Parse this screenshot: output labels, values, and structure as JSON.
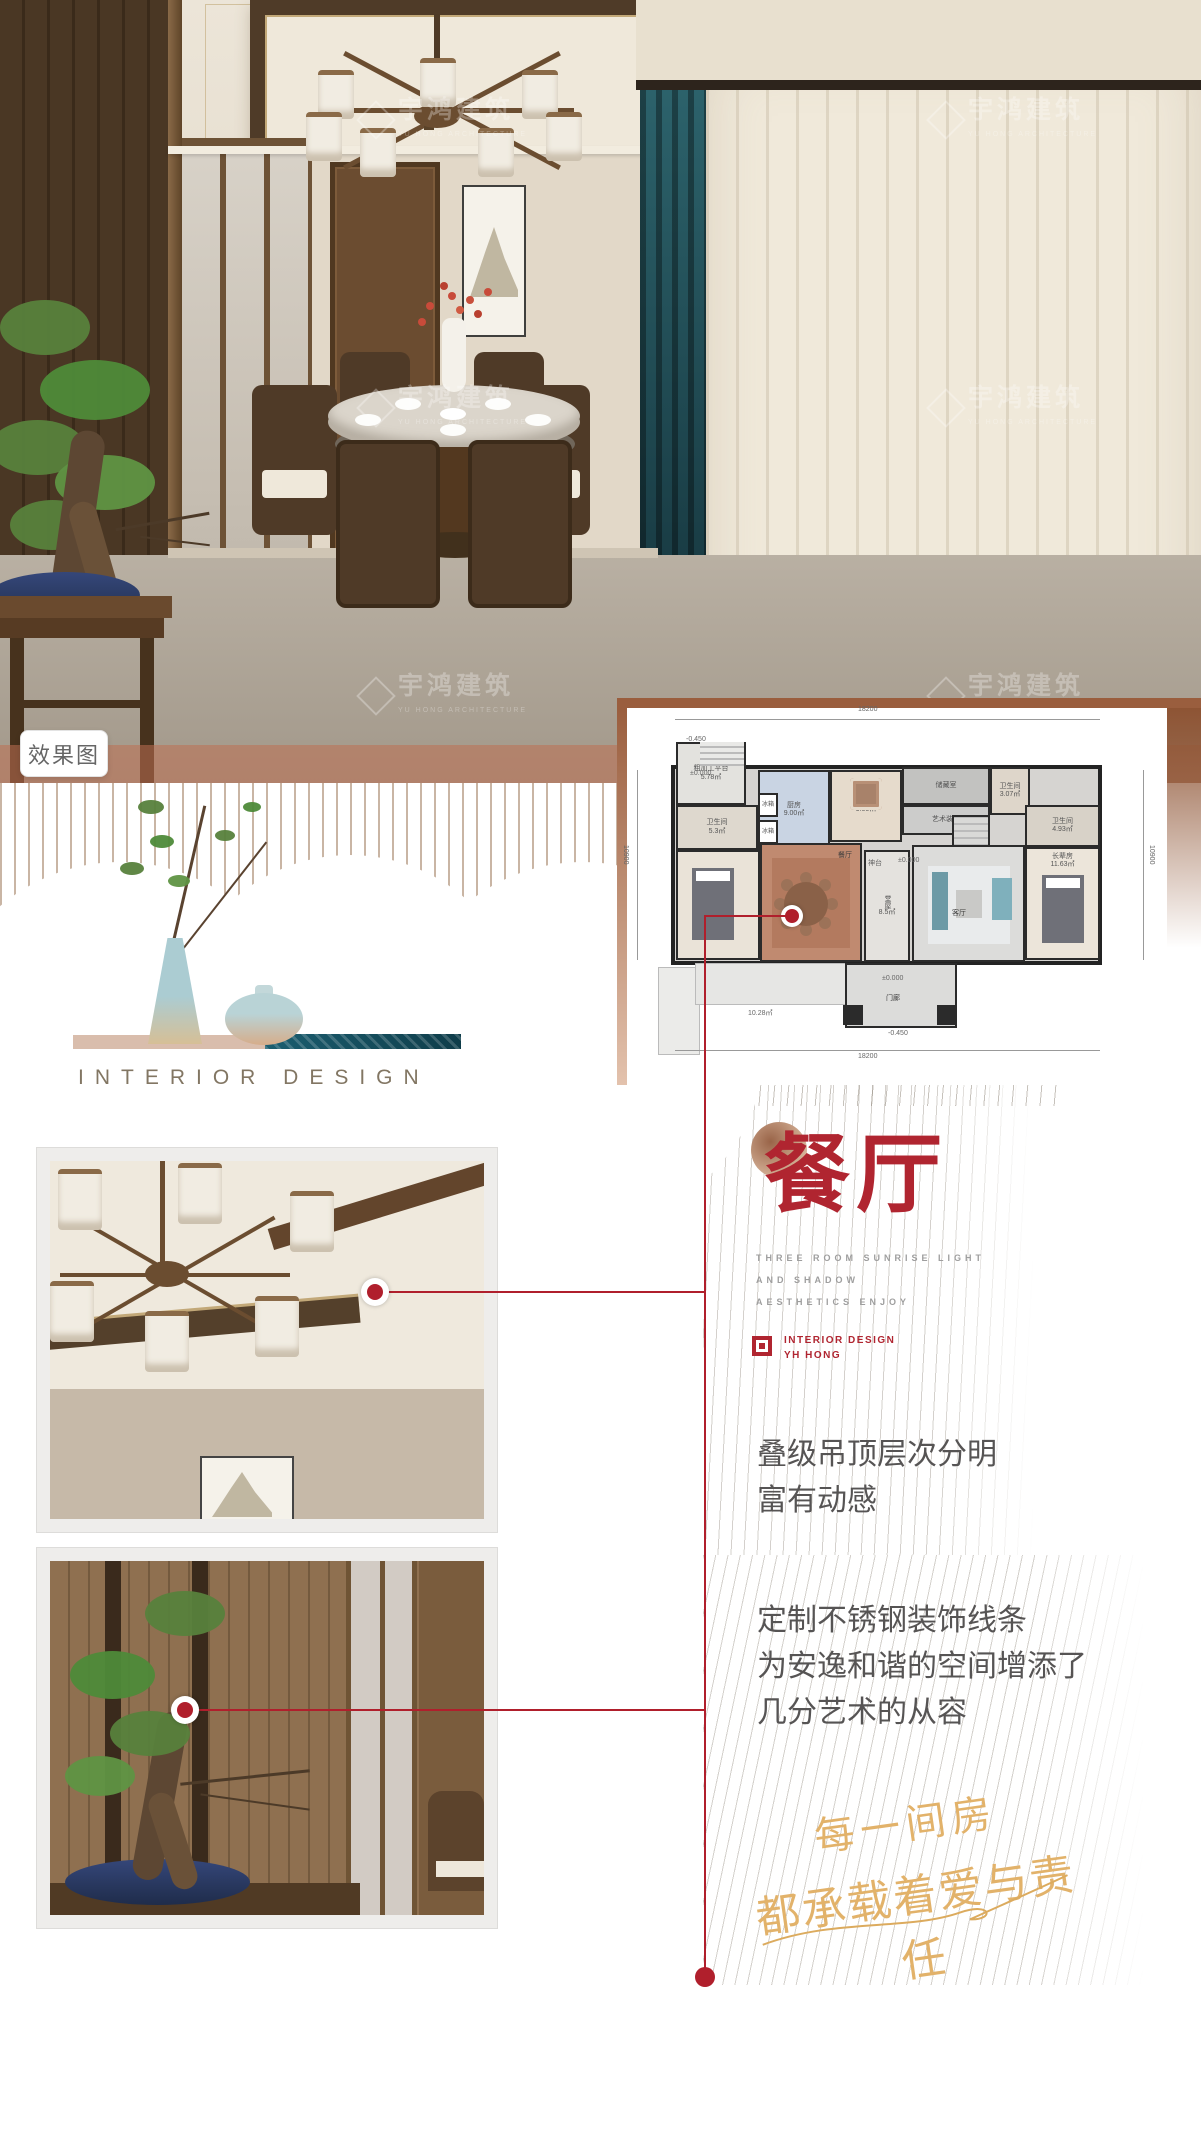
{
  "watermark": {
    "cn": "宇鸿建筑",
    "en": "YU HONG ARCHITECTURE"
  },
  "photo_tag": {
    "label": "效果图"
  },
  "still_life": {
    "caption": "INTERIOR DESIGN"
  },
  "plan": {
    "dim_top": "18200",
    "dim_bottom": "18200",
    "dim_left": "10900",
    "dim_right": "10900",
    "elev_zero": "±0.000",
    "elev_neg": "-0.450",
    "rooms": [
      {
        "label": "粗加工平台",
        "area": "5.78㎡"
      },
      {
        "label": "卫生间",
        "area": "5.3㎡"
      },
      {
        "label": "厨房",
        "area": "9.00㎡"
      },
      {
        "label": "功能房",
        "area": "9.00㎡"
      },
      {
        "label": "储藏室",
        "area": ""
      },
      {
        "label": "艺术装置",
        "area": ""
      },
      {
        "label": "卫生间",
        "area": "3.07㎡"
      },
      {
        "label": "卫生间",
        "area": "4.93㎡"
      },
      {
        "label": "长辈房",
        "area": "11.63㎡"
      },
      {
        "label": "餐厅",
        "area": ""
      },
      {
        "label": "客厅",
        "area": ""
      },
      {
        "label": "堂屋",
        "area": "8.5㎡"
      },
      {
        "label": "神台",
        "area": ""
      },
      {
        "label": "门廊",
        "area": "10.28㎡"
      },
      {
        "label": "冰箱",
        "area": ""
      }
    ]
  },
  "section": {
    "title": "餐厅",
    "subtitle_lines": [
      "THREE ROOM SUNRISE LIGHT",
      "AND SHADOW",
      "AESTHETICS ENJOY"
    ],
    "brand_line1": "INTERIOR DESIGN",
    "brand_line2": "YH HONG"
  },
  "features": [
    {
      "lines": [
        "叠级吊顶层次分明",
        "富有动感"
      ]
    },
    {
      "lines": [
        "定制不锈钢装饰线条",
        "为安逸和谐的空间增添了",
        "几分艺术的从容"
      ]
    }
  ],
  "slogan": {
    "line1": "每一间房",
    "line2": "都承载着爱与责任"
  }
}
